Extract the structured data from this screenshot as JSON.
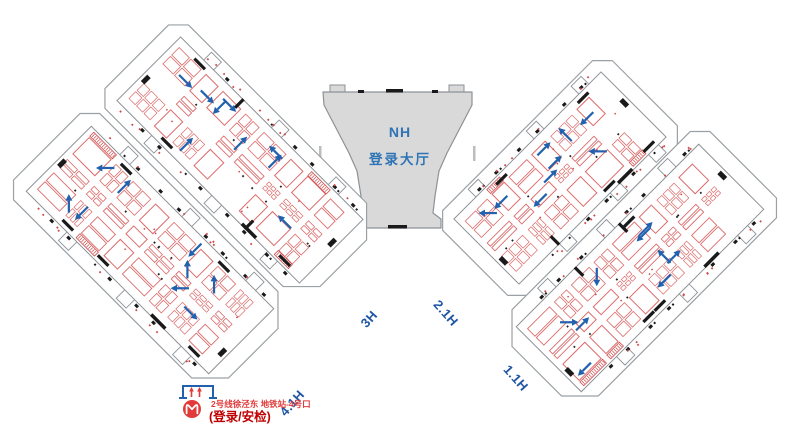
{
  "map": {
    "lobby": {
      "line1": "NH",
      "line2": "登录大厅"
    },
    "halls": [
      {
        "label": "4.1H"
      },
      {
        "label": "3H"
      },
      {
        "label": "2.1H"
      },
      {
        "label": "1.1H"
      }
    ],
    "metro": {
      "station_text": "2号线徐泾东 地铁站-4号口",
      "security_text": "(登录/安检)"
    },
    "colors": {
      "hall_label_blue": "#2156a5",
      "lobby_text_blue": "#2e74b5",
      "lobby_fill": "#d9d9d9",
      "outline_gray": "#9aa0a4",
      "floor_line_gray": "#8d9297",
      "booth_red": "#dd6a6a",
      "hatch_red": "#d04848",
      "arrow_blue": "#2161ae",
      "metro_red": "#e03a3a",
      "security_red": "#c00000",
      "black_detail": "#1a1a1a"
    }
  }
}
